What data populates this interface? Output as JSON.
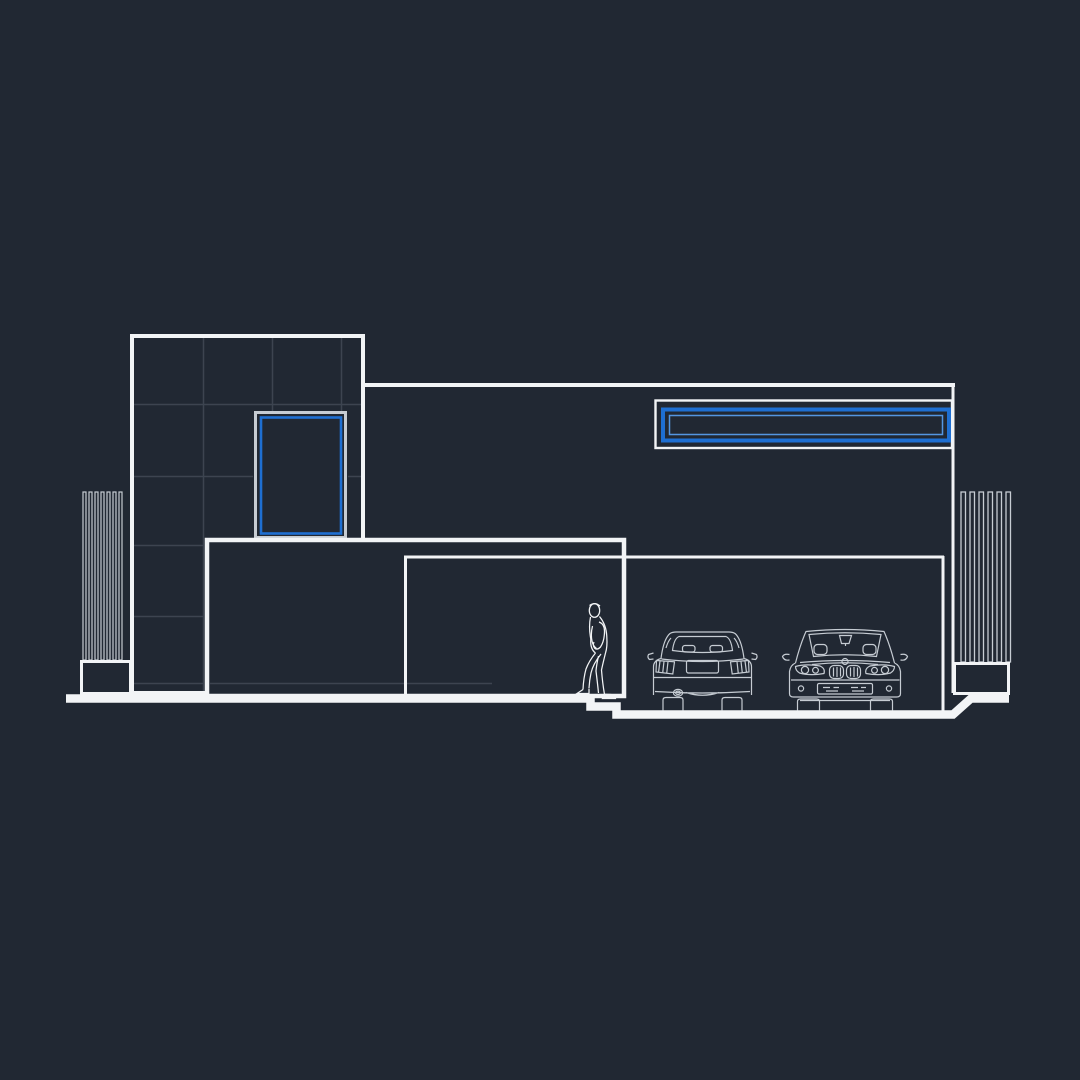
{
  "canvas": {
    "width": 1080,
    "height": 1080,
    "colors": {
      "background": "#212833",
      "line-bright": "#f2f4f6",
      "line-soft": "#c6ccd3",
      "line-faint": "#9aa2ab",
      "grid": "#3d4450",
      "accent-blue": "#1e6fd2",
      "accent-blue-light": "#5496e2"
    }
  },
  "drawing": {
    "type": "architectural-front-elevation-line-drawing",
    "left_tower": {
      "tile_grid": {
        "vertical_lines": 3,
        "horizontal_lines": 5
      },
      "window": {
        "frame": "white",
        "inner_frame": "blue"
      }
    },
    "right_block": {
      "strip_window": {
        "frame": "white",
        "inner_frame": "blue",
        "inner_line": "light-blue"
      }
    },
    "fence_left": {
      "slats": 7,
      "base": "plinth-box"
    },
    "fence_right": {
      "slats": 6,
      "base": "plinth-box"
    },
    "garage": {
      "vehicles": [
        {
          "id": "car-rear-view",
          "style": "sedan seen from rear"
        },
        {
          "id": "car-front-view",
          "style": "sedan seen from front"
        }
      ]
    },
    "figures": [
      {
        "id": "person",
        "pose": "walking up steps, facing left"
      }
    ],
    "ground": {
      "profile": "street level, two steps down to garage slab, ramp up at right"
    }
  }
}
